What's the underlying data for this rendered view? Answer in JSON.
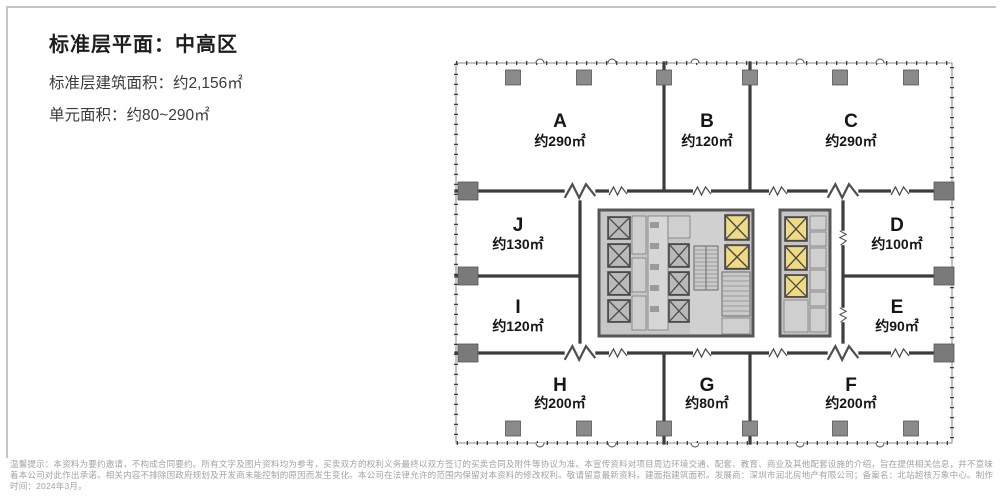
{
  "header": {
    "title": "标准层平面：中高区",
    "gross_area_line": "标准层建筑面积：约2,156㎡",
    "unit_area_line": "单元面积：约80~290㎡"
  },
  "plan": {
    "units": [
      {
        "id": "A",
        "area": "约290㎡"
      },
      {
        "id": "B",
        "area": "约120㎡"
      },
      {
        "id": "C",
        "area": "约290㎡"
      },
      {
        "id": "D",
        "area": "约100㎡"
      },
      {
        "id": "E",
        "area": "约90㎡"
      },
      {
        "id": "F",
        "area": "约200㎡"
      },
      {
        "id": "G",
        "area": "约80㎡"
      },
      {
        "id": "H",
        "area": "约200㎡"
      },
      {
        "id": "I",
        "area": "约120㎡"
      },
      {
        "id": "J",
        "area": "约130㎡"
      }
    ],
    "colors": {
      "highlight": "#F0DB85",
      "wall": "#3C3C3C",
      "core_fill": "#C6C6C6",
      "column": "#8A8A8A"
    }
  },
  "disclaimer": {
    "line1": "温馨提示：本资料为要约邀请，不构成合同要约。所有文字及图片资料均为参考，买卖双方的权利义务最终以双方签订的买卖合同及附件等协议为准。本宣传资料对项目周边环境交通、配套、教育、商业及其他配套设施的介绍，旨在提供相关信息，并不意味",
    "line2": "着本公司对此作出承诺。相关内容不排除因政府规划及开发商未能控制的原因而发生变化。本公司在法律允许的范围内保留对本资料的修改权利。敬请留意最新资料。建面指建筑面积。发展商：深圳市润北房地产有限公司；备案名：北站超核万象中心。制作",
    "line3": "时间：2024年3月。"
  }
}
